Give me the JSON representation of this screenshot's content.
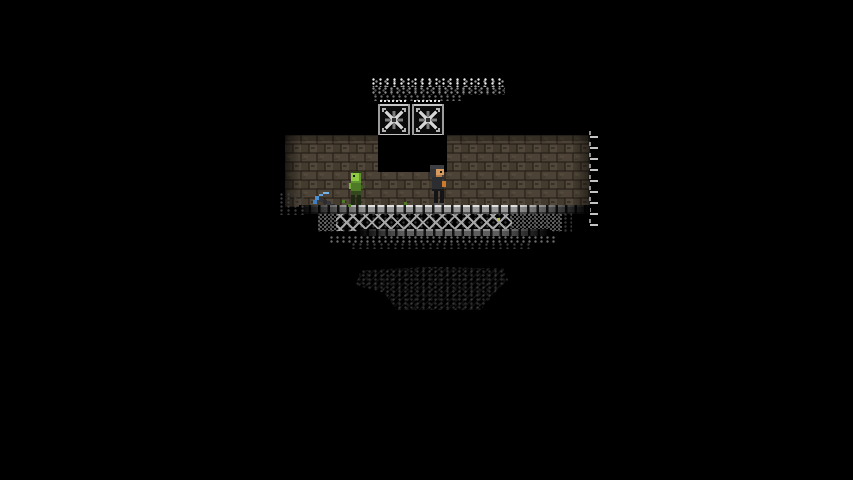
{
  "meta": {
    "app": "pixel-platformer-game",
    "scene": "underground-stone-room-in-darkness"
  },
  "visible_text": [],
  "canvas": {
    "width": 853,
    "height": 480,
    "background": "#000000"
  },
  "palette": {
    "bg": "#000000",
    "brick_mid": "#4c4336",
    "brick_dark": "#443b2f",
    "brick_light": "#51473a",
    "mortar": "#1f1a13",
    "metal_light": "#d9d9d9",
    "metal_mid": "#979797",
    "metal_dark": "#4f4f4f",
    "zombie_green": "#8fcb42",
    "zombie_body": "#4e7a28",
    "moss_green": "#4e7a22",
    "player_skin": "#d79a60",
    "player_hair": "#3c3e42",
    "item_orange": "#cd7a2e",
    "pickaxe_blue": "#4a8fd4",
    "dust_white": "#e3e3e3",
    "faint_terrain": "#242424"
  },
  "entities": {
    "dust_row_bright": {
      "x": 372,
      "y": 78,
      "w": 133,
      "h": 9
    },
    "dust_row_mid": {
      "x": 372,
      "y": 87,
      "w": 133,
      "h": 8
    },
    "dust_row_low": {
      "x": 374,
      "y": 95,
      "w": 90,
      "h": 6
    },
    "fan_left": {
      "x": 378,
      "y": 100,
      "w": 32,
      "h": 36
    },
    "fan_right": {
      "x": 412,
      "y": 100,
      "w": 32,
      "h": 36
    },
    "brick_wall": {
      "x": 285,
      "y": 135,
      "w": 305,
      "h": 72
    },
    "shaft_gap": {
      "x": 378,
      "y": 135,
      "w": 69,
      "h": 37
    },
    "ladder": {
      "x": 589,
      "y": 133,
      "w": 13,
      "h": 104,
      "marks": 9
    },
    "zombie": {
      "x": 347,
      "y": 171,
      "w": 20,
      "h": 36
    },
    "player": {
      "x": 426,
      "y": 165,
      "w": 22,
      "h": 42
    },
    "pickaxe_item": {
      "x": 313,
      "y": 190,
      "w": 24,
      "h": 20
    },
    "floor_rail": {
      "x": 299,
      "y": 205,
      "w": 291,
      "h": 9
    },
    "truss_backdots": {
      "x": 318,
      "y": 213,
      "w": 254,
      "h": 20
    },
    "truss": {
      "x": 336,
      "y": 214,
      "w": 176,
      "h": 17
    },
    "truss_fade_left": {
      "x": 318,
      "y": 214,
      "w": 20,
      "h": 17
    },
    "truss_fade_right": {
      "x": 510,
      "y": 214,
      "w": 52,
      "h": 17
    },
    "bottom_rail": {
      "x": 357,
      "y": 229,
      "w": 193,
      "h": 7
    },
    "under_dither_1": {
      "x": 330,
      "y": 236,
      "w": 228,
      "h": 7
    },
    "under_dither_2": {
      "x": 352,
      "y": 243,
      "w": 180,
      "h": 6
    },
    "left_edge_dither": {
      "x": 280,
      "y": 193,
      "w": 24,
      "h": 22
    },
    "terrain_faint": {
      "x": 356,
      "y": 266,
      "w": 152,
      "h": 44
    },
    "moss_dots": [
      {
        "x": 342,
        "y": 200,
        "w": 3,
        "h": 3
      },
      {
        "x": 348,
        "y": 204,
        "w": 3,
        "h": 3
      },
      {
        "x": 404,
        "y": 202,
        "w": 3,
        "h": 3
      }
    ],
    "ore_dot": {
      "x": 497,
      "y": 218,
      "w": 3,
      "h": 3
    }
  }
}
